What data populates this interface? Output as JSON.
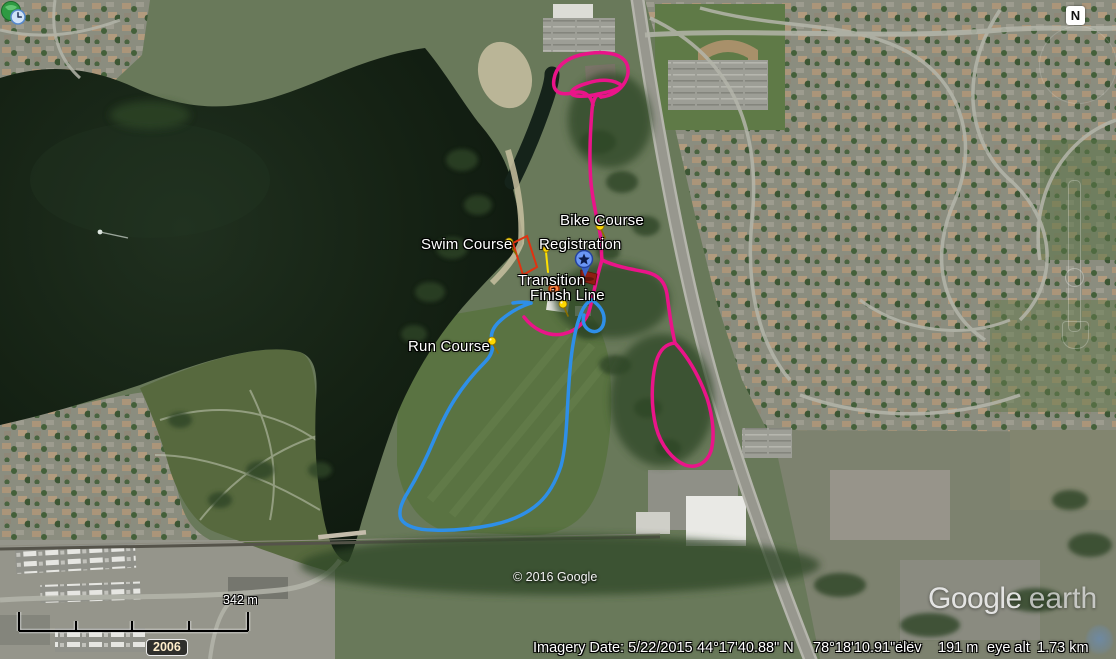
{
  "app_title": "Google Earth",
  "map": {
    "placemark_labels": {
      "swim_course": "Swim Course",
      "bike_course": "Bike Course",
      "registration": "Registration",
      "transition": "Transition",
      "finish_line": "Finish Line",
      "run_course": "Run Course"
    },
    "route_colors": {
      "bike_course": "#ea1489",
      "run_course": "#2e8fe8",
      "swim_course": "#e23210",
      "pushpin": "#ffd900",
      "placemark_blue": "#6b97f5",
      "flag_red": "#8e1f12",
      "transition_dot": "#ff8844"
    }
  },
  "controls": {
    "compass": "N",
    "scale_label": "342 m",
    "time_slider_year": "2006"
  },
  "footer": {
    "copyright": "© 2016 Google",
    "logo_google": "Google",
    "logo_earth": "earth",
    "status": {
      "imagery_date": "Imagery Date: 5/22/2015",
      "latitude": "44°17'40.88\" N",
      "longitude": "78°18'10.91\" W",
      "elev_label": "elev",
      "elevation": "191 m",
      "eye_alt_label": "eye alt",
      "eye_altitude": "1.73 km"
    }
  }
}
